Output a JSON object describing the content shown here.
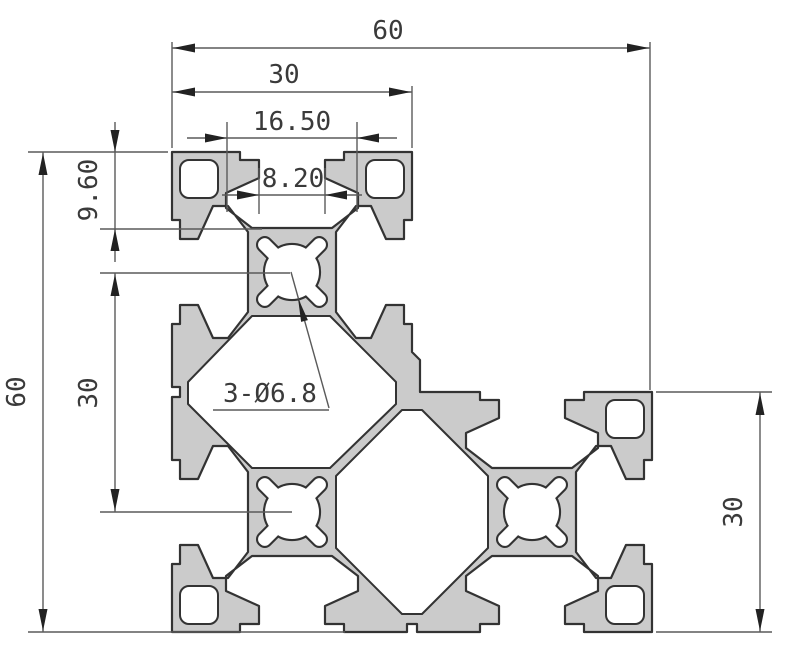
{
  "drawing": {
    "description": "Cross-section drawing of an L-shaped aluminum T-slot extrusion profile (three 30x30 modules) with dimensions",
    "colors": {
      "background": "#ffffff",
      "material_fill": "#cbcbcb",
      "outline": "#333333",
      "dimension_line": "#5a5a5a",
      "dimension_text": "#3a3a3a"
    },
    "labels": {
      "overall_width_top": "60",
      "module_width_top": "30",
      "slot_cavity_width": "16.50",
      "slot_opening_width": "8.20",
      "overall_height_left": "60",
      "module_pitch_left": "30",
      "slot_depth_left": "9.60",
      "module_height_right": "30",
      "hole_callout": "3-Ø6.8"
    }
  }
}
